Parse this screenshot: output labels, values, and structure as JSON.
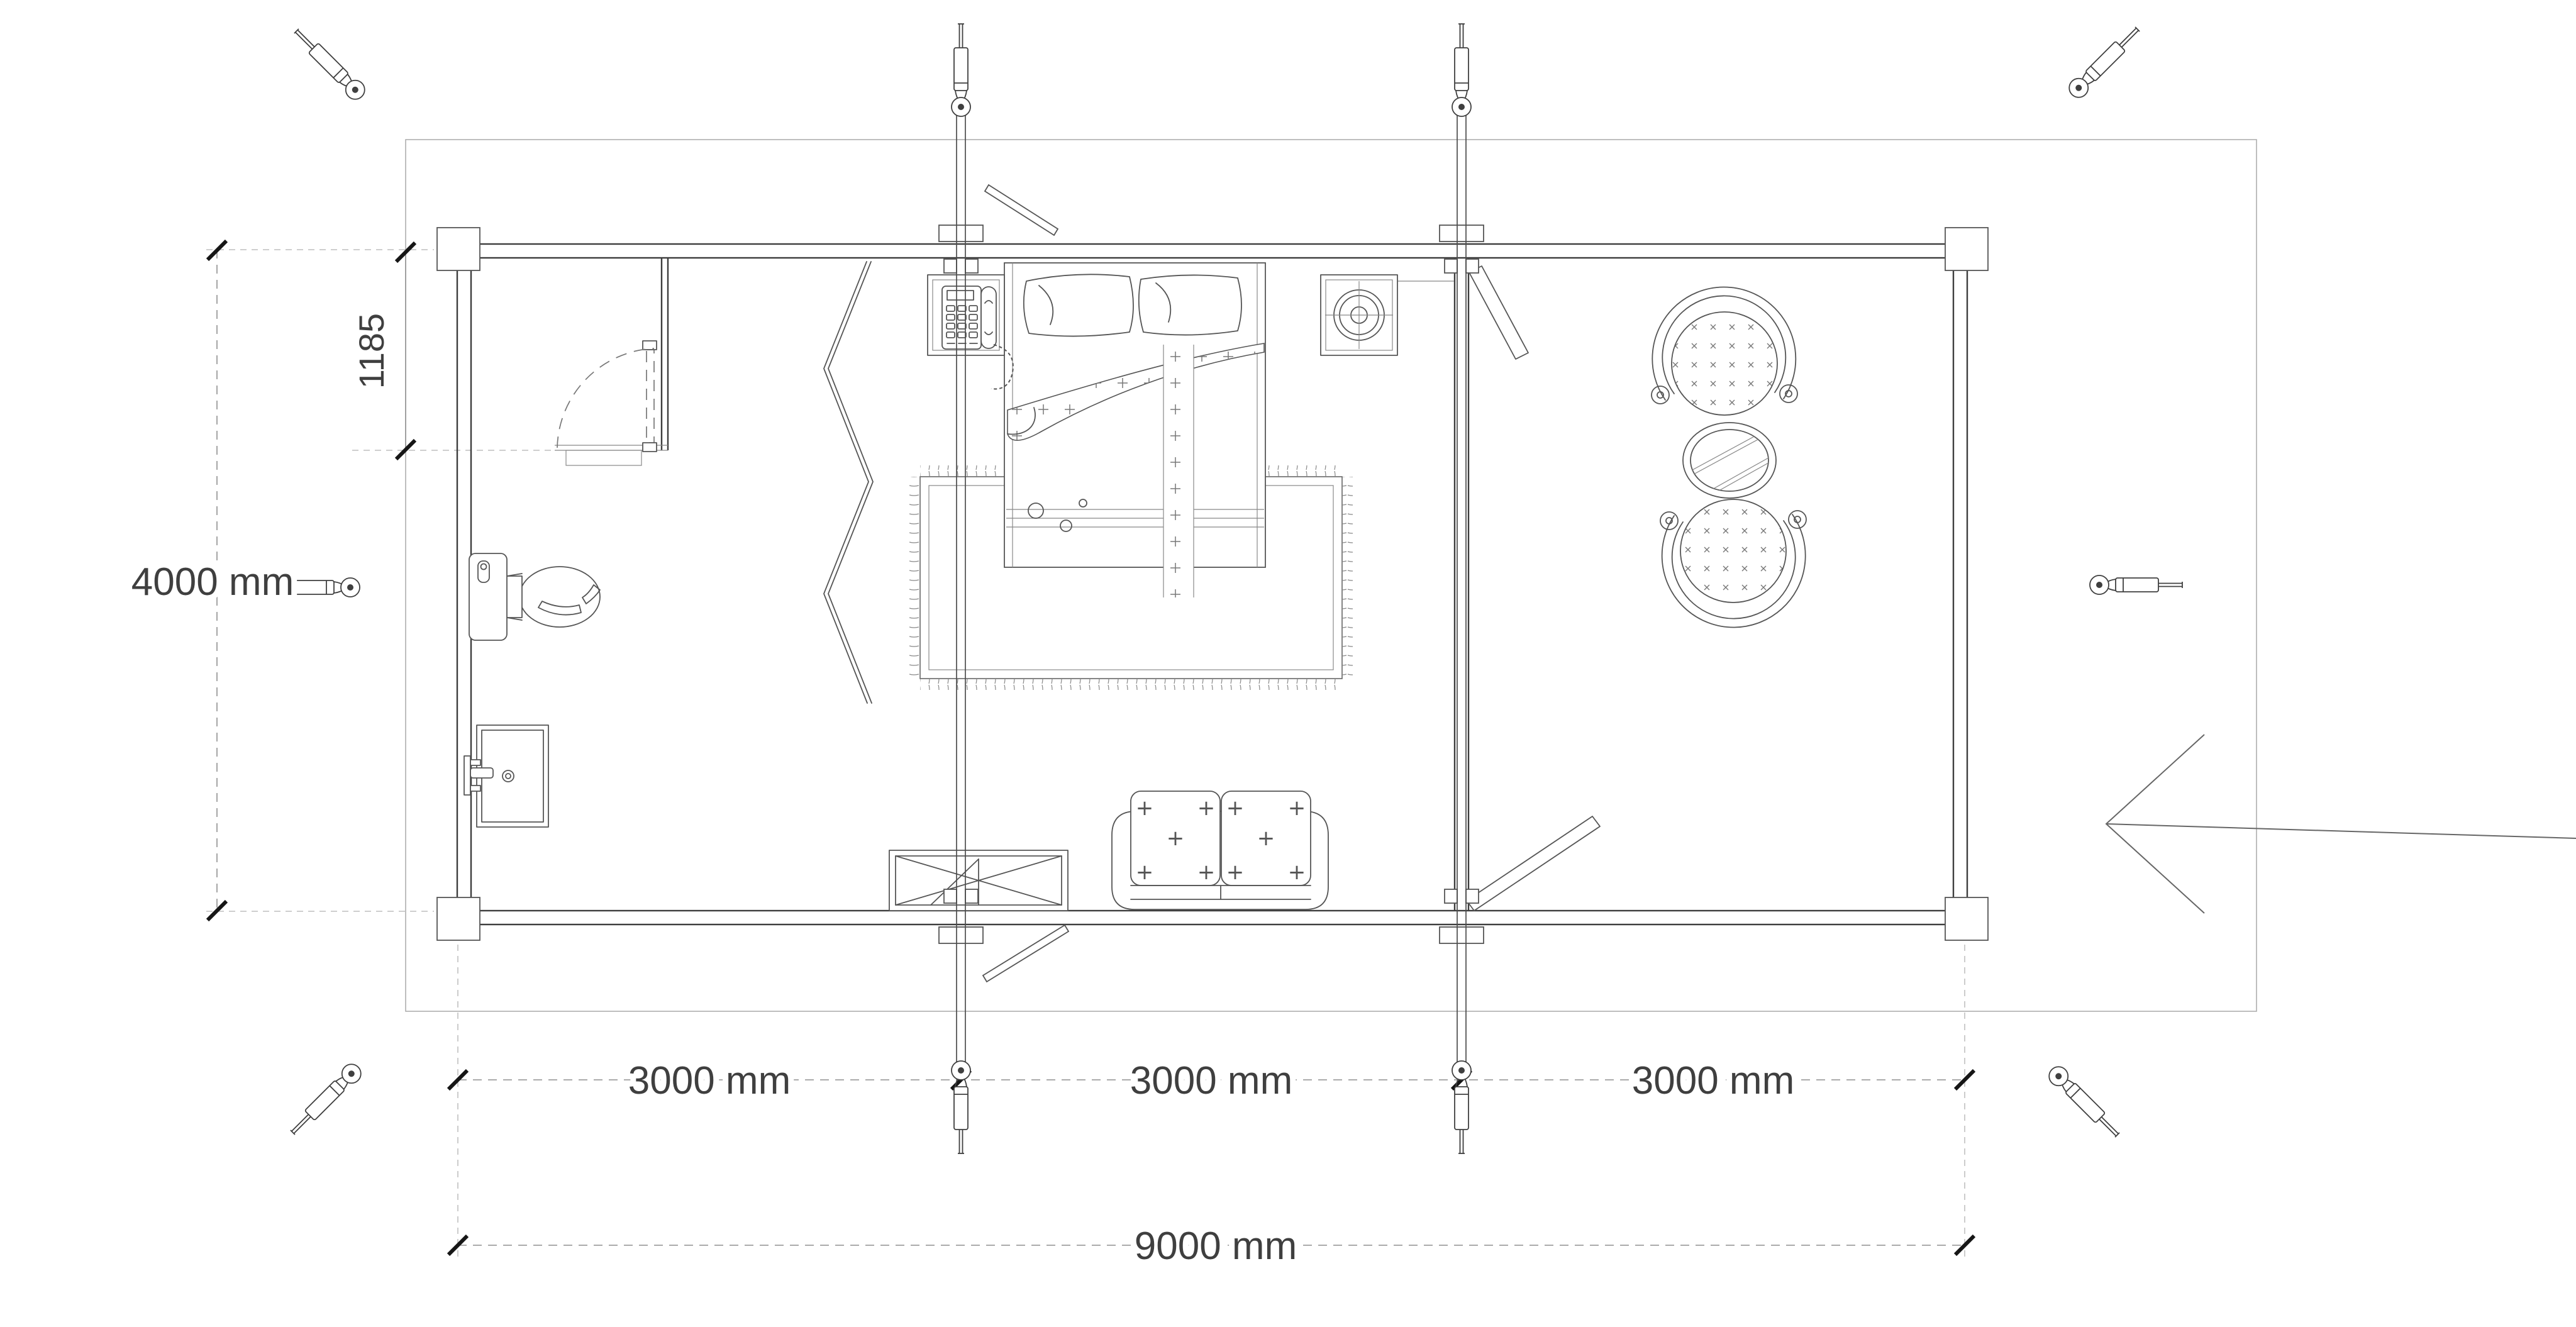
{
  "page": {
    "background": "#ffffff"
  },
  "drawing": {
    "type": "floor-plan-top-view",
    "dimensions": {
      "height_label": "4000 mm",
      "entry_offset_label": "1185",
      "bays": [
        {
          "label": "3000 mm"
        },
        {
          "label": "3000 mm"
        },
        {
          "label": "3000 mm"
        }
      ],
      "total_label": "9000 mm"
    },
    "colors": {
      "wall": "#3d3d3d",
      "furniture_line": "#555555",
      "dimension_line": "#8f8f8f",
      "deck_line": "#a8a8a8",
      "tick": "#161616",
      "text": "#3f3f3f"
    },
    "elements": [
      "deck-outline",
      "exterior-log-walls",
      "corner-posts",
      "interior-partition",
      "bathroom-door-swing",
      "folding-screen",
      "toilet",
      "bathroom-sink",
      "telephone-nightstand",
      "burner-nightstand",
      "double-bed",
      "area-rug",
      "loveseat-sofa",
      "crossed-window",
      "armchair-top",
      "armchair-bottom",
      "round-coffee-table",
      "tie-rods-with-turnbuckles",
      "corner-turnbuckle-icons",
      "entry-direction-arrow",
      "diagonal-braces"
    ]
  }
}
